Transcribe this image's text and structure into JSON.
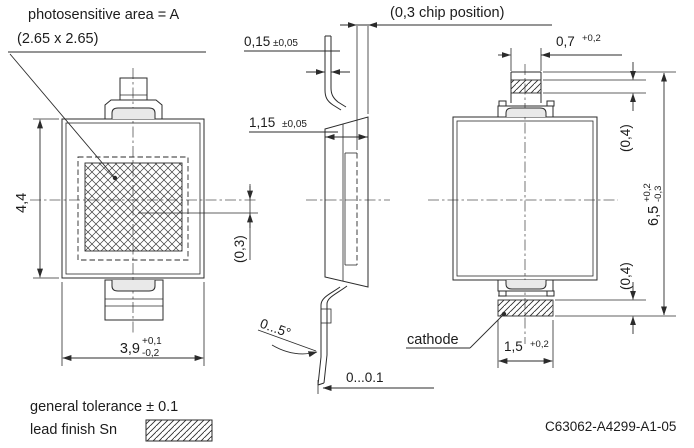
{
  "drawing": {
    "ink_color": "#2b2b2b",
    "background_color": "#ffffff",
    "annotations": {
      "photosensitive_label_line1": "photosensitive area = A",
      "photosensitive_label_line2": "(2.65 x 2.65)",
      "chip_position_label": "(0,3 chip position)",
      "dim_lead_thickness": "0,15",
      "dim_lead_thickness_tol": "±0,05",
      "dim_body_thickness": "1,15",
      "dim_body_thickness_tol": "±0,05",
      "dim_body_height": "4,4",
      "dim_chip_offset": "(0,3)",
      "dim_top_lead_width": "0,7",
      "dim_top_lead_width_tol_plus": "+0,2",
      "dim_lead_protrusion_top": "(0,4)",
      "dim_total_height": "6,5",
      "dim_total_height_tol_plus": "+0,2",
      "dim_total_height_tol_minus": "-0,3",
      "dim_lead_protrusion_bottom": "(0,4)",
      "dim_body_width": "3,9",
      "dim_body_width_tol_plus": "+0,1",
      "dim_body_width_tol_minus": "-0,2",
      "dim_lead_angle": "0...5°",
      "dim_coplanarity": "0...0.1",
      "cathode_label": "cathode",
      "dim_cathode_width": "1,5",
      "dim_cathode_width_tol_plus": "+0,2",
      "general_tolerance_note": "general tolerance ± 0.1",
      "lead_finish_note": "lead finish Sn",
      "document_number": "C63062-A4299-A1-05"
    }
  }
}
